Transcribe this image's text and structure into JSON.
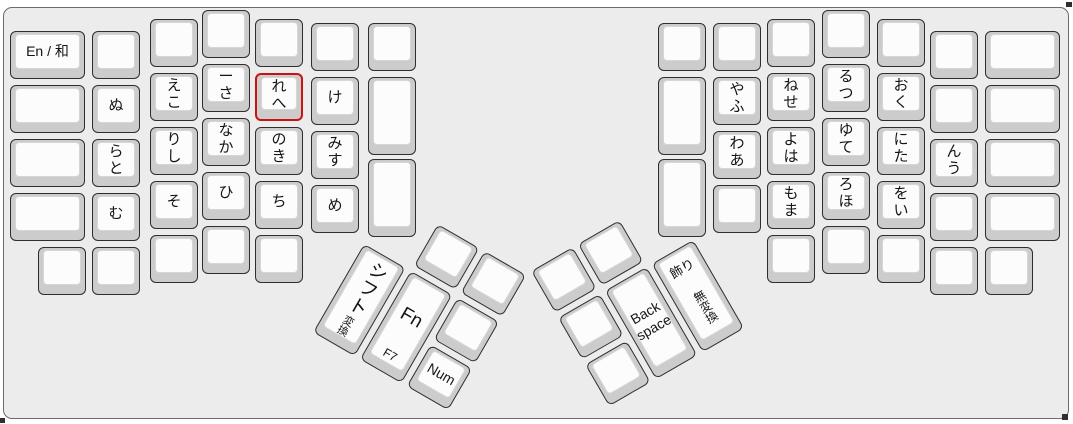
{
  "colors": {
    "canvas_bg": "#ececec",
    "key_base": "#cccccc",
    "key_top": "#fcfcfc",
    "key_border": "#2e2e2e",
    "key_top_border": "#d6d6d6",
    "highlight": "#cc1111",
    "frame_border": "#6b6b6b"
  },
  "main_keys": [
    {
      "x": 10,
      "y": 31,
      "w": 75,
      "c": "En / 和",
      "n": "en-wa",
      "cs": "latin"
    },
    {
      "x": 10,
      "y": 85,
      "w": 75
    },
    {
      "x": 10,
      "y": 139,
      "w": 75
    },
    {
      "x": 10,
      "y": 193,
      "w": 75
    },
    {
      "x": 38,
      "y": 247
    },
    {
      "x": 92,
      "y": 31
    },
    {
      "x": 92,
      "y": 85,
      "c": "ぬ",
      "n": "nu"
    },
    {
      "x": 92,
      "y": 139,
      "t": "ら",
      "b": "と",
      "n": "ra-to"
    },
    {
      "x": 92,
      "y": 193,
      "c": "む",
      "n": "mu"
    },
    {
      "x": 92,
      "y": 247
    },
    {
      "x": 150,
      "y": 19
    },
    {
      "x": 150,
      "y": 73,
      "t": "え",
      "b": "こ",
      "n": "e-ko"
    },
    {
      "x": 150,
      "y": 127,
      "t": "り",
      "b": "し",
      "n": "ri-shi"
    },
    {
      "x": 150,
      "y": 181,
      "c": "そ",
      "n": "so"
    },
    {
      "x": 150,
      "y": 235
    },
    {
      "x": 202,
      "y": 10
    },
    {
      "x": 202,
      "y": 64,
      "t": "ー",
      "b": "さ",
      "n": "chouon-sa"
    },
    {
      "x": 202,
      "y": 118,
      "t": "な",
      "b": "か",
      "n": "na-ka"
    },
    {
      "x": 202,
      "y": 172,
      "c": "ひ",
      "n": "hi"
    },
    {
      "x": 202,
      "y": 226
    },
    {
      "x": 255,
      "y": 19
    },
    {
      "x": 255,
      "y": 73,
      "t": "れ",
      "b": "へ",
      "n": "re-he",
      "red": true
    },
    {
      "x": 255,
      "y": 127,
      "t": "の",
      "b": "き",
      "n": "no-ki"
    },
    {
      "x": 255,
      "y": 181,
      "c": "ち",
      "n": "chi"
    },
    {
      "x": 255,
      "y": 235
    },
    {
      "x": 311,
      "y": 23
    },
    {
      "x": 311,
      "y": 77,
      "c": "け",
      "n": "ke"
    },
    {
      "x": 311,
      "y": 131,
      "t": "み",
      "b": "す",
      "n": "mi-su"
    },
    {
      "x": 311,
      "y": 185,
      "c": "め",
      "n": "me"
    },
    {
      "x": 368,
      "y": 23
    },
    {
      "x": 368,
      "y": 77,
      "h": 78
    },
    {
      "x": 368,
      "y": 159,
      "h": 78
    },
    {
      "x": 658,
      "y": 23
    },
    {
      "x": 658,
      "y": 77,
      "h": 78
    },
    {
      "x": 658,
      "y": 159,
      "h": 78
    },
    {
      "x": 713,
      "y": 23
    },
    {
      "x": 713,
      "y": 77,
      "t": "や",
      "b": "ふ",
      "n": "ya-fu"
    },
    {
      "x": 713,
      "y": 131,
      "t": "わ",
      "b": "あ",
      "n": "wa-a"
    },
    {
      "x": 713,
      "y": 185
    },
    {
      "x": 767,
      "y": 19
    },
    {
      "x": 767,
      "y": 73,
      "t": "ね",
      "b": "せ",
      "n": "ne-se"
    },
    {
      "x": 767,
      "y": 127,
      "t": "よ",
      "b": "は",
      "n": "yo-ha"
    },
    {
      "x": 767,
      "y": 181,
      "t": "も",
      "b": "ま",
      "n": "mo-ma"
    },
    {
      "x": 767,
      "y": 235
    },
    {
      "x": 822,
      "y": 10
    },
    {
      "x": 822,
      "y": 64,
      "t": "る",
      "b": "つ",
      "n": "ru-tsu"
    },
    {
      "x": 822,
      "y": 118,
      "t": "ゆ",
      "b": "て",
      "n": "yu-te"
    },
    {
      "x": 822,
      "y": 172,
      "t": "ろ",
      "b": "ほ",
      "n": "ro-ho"
    },
    {
      "x": 822,
      "y": 226
    },
    {
      "x": 877,
      "y": 19
    },
    {
      "x": 877,
      "y": 73,
      "t": "お",
      "b": "く",
      "n": "o-ku"
    },
    {
      "x": 877,
      "y": 127,
      "t": "に",
      "b": "た",
      "n": "ni-ta"
    },
    {
      "x": 877,
      "y": 181,
      "t": "を",
      "b": "い",
      "n": "wo-i"
    },
    {
      "x": 877,
      "y": 235
    },
    {
      "x": 930,
      "y": 31
    },
    {
      "x": 930,
      "y": 85
    },
    {
      "x": 930,
      "y": 139,
      "t": "ん",
      "b": "う",
      "n": "n-u"
    },
    {
      "x": 930,
      "y": 193
    },
    {
      "x": 930,
      "y": 247
    },
    {
      "x": 985,
      "y": 31,
      "w": 75
    },
    {
      "x": 985,
      "y": 85,
      "w": 75
    },
    {
      "x": 985,
      "y": 139,
      "w": 75
    },
    {
      "x": 985,
      "y": 193,
      "w": 75
    },
    {
      "x": 985,
      "y": 247
    }
  ],
  "thumb_clusters": [
    {
      "name": "left-thumb-cluster",
      "x": 390,
      "y": 193,
      "rot": 30,
      "keys": [
        {
          "x": 57,
          "y": 3
        },
        {
          "x": 111,
          "y": 3
        },
        {
          "x": 3,
          "y": 57,
          "h": 102,
          "c": "シフト",
          "b": "変換",
          "n": "shift-henkan",
          "cs": "v jp-big",
          "bs": "v tiny"
        },
        {
          "x": 57,
          "y": 57,
          "h": 102,
          "c": "Fn",
          "b": "F7",
          "n": "fn-f7",
          "cs": "latin-big",
          "bs": "small"
        },
        {
          "x": 111,
          "y": 57
        },
        {
          "x": 111,
          "y": 111,
          "c": "Num",
          "n": "num",
          "cs": "latin"
        }
      ]
    },
    {
      "name": "right-thumb-cluster",
      "x": 527,
      "y": 270,
      "rot": -30,
      "keys": [
        {
          "x": 3,
          "y": 3
        },
        {
          "x": 57,
          "y": 3
        },
        {
          "x": 3,
          "y": 57
        },
        {
          "x": 57,
          "y": 57,
          "h": 102,
          "c": "Back\nspace",
          "n": "backspace",
          "cs": "latin"
        },
        {
          "x": 111,
          "y": 57,
          "h": 102,
          "t": "飾り",
          "b": "無変換",
          "n": "kazari-muhenkan",
          "ts": "jp-small",
          "bs": "v small"
        },
        {
          "x": 3,
          "y": 111
        }
      ]
    }
  ]
}
